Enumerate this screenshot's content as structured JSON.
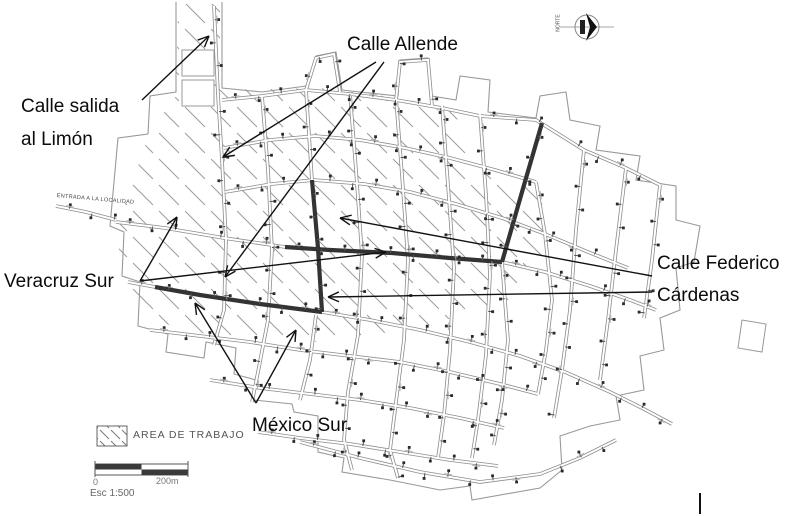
{
  "annotations": {
    "salida_limon": {
      "line1": "Calle salida",
      "line2": "al Limón"
    },
    "allende": {
      "label": "Calle Allende"
    },
    "veracruz": {
      "label": "Veracruz Sur"
    },
    "federico": {
      "line1": "Calle Federico",
      "line2": "Cárdenas"
    },
    "mexico": {
      "label": "México Sur"
    }
  },
  "map_texts": {
    "entrance_road": "ENTRADA A LA LOCALIDAD",
    "north": "NORTE"
  },
  "legend": {
    "work_area": "AREA DE TRABAJO"
  },
  "scale_bar": {
    "start": "0",
    "end": "200m",
    "scale": "Esc 1:500"
  },
  "colors": {
    "ink": "#111111",
    "street_casing": "#8c8c8c",
    "bold_street": "#333333",
    "hatch": "#9a9a9a",
    "boundary": "#999999",
    "tick": "#555555",
    "tick_head": "#2a2a2a"
  },
  "geometry": {
    "boundary": [
      [
        176,
        2
      ],
      [
        176,
        92
      ],
      [
        150,
        96
      ],
      [
        148,
        134
      ],
      [
        118,
        138
      ],
      [
        110,
        226
      ],
      [
        124,
        232
      ],
      [
        122,
        276
      ],
      [
        140,
        282
      ],
      [
        138,
        326
      ],
      [
        168,
        334
      ],
      [
        166,
        352
      ],
      [
        204,
        358
      ],
      [
        206,
        342
      ],
      [
        236,
        348
      ],
      [
        234,
        374
      ],
      [
        256,
        380
      ],
      [
        254,
        400
      ],
      [
        292,
        404
      ],
      [
        294,
        412
      ],
      [
        318,
        416
      ],
      [
        318,
        452
      ],
      [
        344,
        458
      ],
      [
        342,
        472
      ],
      [
        390,
        480
      ],
      [
        440,
        490
      ],
      [
        470,
        486
      ],
      [
        472,
        500
      ],
      [
        540,
        488
      ],
      [
        562,
        470
      ],
      [
        560,
        436
      ],
      [
        590,
        426
      ],
      [
        620,
        420
      ],
      [
        616,
        396
      ],
      [
        644,
        390
      ],
      [
        640,
        356
      ],
      [
        664,
        350
      ],
      [
        660,
        318
      ],
      [
        680,
        310
      ],
      [
        676,
        268
      ],
      [
        694,
        262
      ],
      [
        700,
        226
      ],
      [
        676,
        220
      ],
      [
        676,
        186
      ],
      [
        636,
        180
      ],
      [
        640,
        156
      ],
      [
        596,
        150
      ],
      [
        600,
        126
      ],
      [
        570,
        120
      ],
      [
        566,
        92
      ],
      [
        540,
        96
      ],
      [
        536,
        118
      ],
      [
        488,
        112
      ],
      [
        490,
        80
      ],
      [
        460,
        76
      ],
      [
        456,
        100
      ],
      [
        432,
        96
      ],
      [
        428,
        58
      ],
      [
        400,
        60
      ],
      [
        398,
        96
      ],
      [
        360,
        92
      ],
      [
        342,
        90
      ],
      [
        336,
        52
      ],
      [
        316,
        56
      ],
      [
        306,
        86
      ],
      [
        262,
        92
      ],
      [
        222,
        88
      ],
      [
        222,
        2
      ]
    ],
    "far_block": [
      [
        742,
        320
      ],
      [
        766,
        324
      ],
      [
        762,
        352
      ],
      [
        738,
        348
      ],
      [
        742,
        320
      ]
    ],
    "hatch_poly": [
      [
        178,
        4
      ],
      [
        220,
        4
      ],
      [
        220,
        90
      ],
      [
        320,
        88
      ],
      [
        400,
        98
      ],
      [
        455,
        110
      ],
      [
        470,
        170
      ],
      [
        540,
        188
      ],
      [
        548,
        248
      ],
      [
        508,
        300
      ],
      [
        430,
        325
      ],
      [
        330,
        342
      ],
      [
        230,
        340
      ],
      [
        150,
        320
      ],
      [
        122,
        270
      ],
      [
        116,
        228
      ],
      [
        150,
        132
      ],
      [
        176,
        96
      ]
    ],
    "white_blocks": [
      [
        182,
        50,
        32,
        26
      ],
      [
        182,
        80,
        32,
        26
      ]
    ],
    "streets": [
      [
        [
          214,
          6
        ],
        [
          218,
          95
        ],
        [
          222,
          160
        ],
        [
          226,
          240
        ],
        [
          224,
          310
        ],
        [
          214,
          345
        ]
      ],
      [
        [
          262,
          96
        ],
        [
          268,
          170
        ],
        [
          272,
          250
        ],
        [
          268,
          320
        ],
        [
          258,
          372
        ],
        [
          252,
          402
        ]
      ],
      [
        [
          306,
          90
        ],
        [
          312,
          180
        ]
      ],
      [
        [
          316,
          315
        ],
        [
          310,
          360
        ],
        [
          300,
          400
        ]
      ],
      [
        [
          350,
          94
        ],
        [
          356,
          170
        ],
        [
          362,
          255
        ],
        [
          358,
          335
        ],
        [
          348,
          392
        ],
        [
          344,
          440
        ],
        [
          352,
          470
        ]
      ],
      [
        [
          396,
          98
        ],
        [
          402,
          175
        ],
        [
          408,
          260
        ],
        [
          404,
          340
        ],
        [
          396,
          402
        ],
        [
          390,
          450
        ],
        [
          398,
          478
        ]
      ],
      [
        [
          442,
          106
        ],
        [
          448,
          185
        ],
        [
          454,
          268
        ],
        [
          450,
          350
        ],
        [
          444,
          415
        ],
        [
          438,
          458
        ]
      ],
      [
        [
          480,
          114
        ],
        [
          486,
          195
        ],
        [
          490,
          275
        ],
        [
          486,
          355
        ],
        [
          478,
          420
        ],
        [
          472,
          458
        ]
      ],
      [
        [
          502,
          262
        ],
        [
          508,
          340
        ],
        [
          502,
          400
        ],
        [
          494,
          445
        ]
      ],
      [
        [
          584,
          150
        ],
        [
          576,
          230
        ],
        [
          570,
          310
        ],
        [
          562,
          370
        ],
        [
          554,
          418
        ]
      ],
      [
        [
          626,
          168
        ],
        [
          616,
          250
        ],
        [
          608,
          320
        ],
        [
          600,
          380
        ]
      ],
      [
        [
          660,
          185
        ],
        [
          652,
          260
        ],
        [
          644,
          318
        ]
      ],
      [
        [
          536,
          182
        ],
        [
          545,
          234
        ],
        [
          552,
          300
        ],
        [
          546,
          350
        ],
        [
          538,
          394
        ]
      ],
      [
        [
          222,
          100
        ],
        [
          262,
          96
        ],
        [
          306,
          90
        ],
        [
          350,
          94
        ],
        [
          396,
          100
        ],
        [
          442,
          108
        ],
        [
          480,
          116
        ]
      ],
      [
        [
          224,
          148
        ],
        [
          270,
          140
        ],
        [
          315,
          136
        ],
        [
          360,
          140
        ],
        [
          405,
          148
        ],
        [
          450,
          158
        ],
        [
          495,
          170
        ],
        [
          536,
          182
        ]
      ],
      [
        [
          225,
          192
        ],
        [
          272,
          184
        ],
        [
          314,
          180
        ],
        [
          364,
          184
        ],
        [
          410,
          192
        ],
        [
          456,
          204
        ],
        [
          502,
          218
        ],
        [
          545,
          234
        ],
        [
          588,
          252
        ],
        [
          628,
          268
        ]
      ],
      [
        [
          116,
          222
        ],
        [
          165,
          228
        ],
        [
          224,
          238
        ],
        [
          285,
          247
        ]
      ],
      [
        [
          502,
          262
        ],
        [
          545,
          272
        ],
        [
          590,
          286
        ],
        [
          630,
          300
        ],
        [
          656,
          310
        ]
      ],
      [
        [
          128,
          282
        ],
        [
          155,
          287
        ]
      ],
      [
        [
          322,
          312
        ],
        [
          370,
          320
        ],
        [
          420,
          330
        ],
        [
          470,
          342
        ],
        [
          520,
          356
        ],
        [
          565,
          372
        ],
        [
          610,
          392
        ],
        [
          642,
          408
        ],
        [
          672,
          424
        ]
      ],
      [
        [
          150,
          330
        ],
        [
          200,
          336
        ],
        [
          250,
          342
        ],
        [
          300,
          350
        ],
        [
          350,
          356
        ],
        [
          400,
          362
        ],
        [
          450,
          372
        ],
        [
          500,
          384
        ],
        [
          538,
          394
        ]
      ],
      [
        [
          210,
          380
        ],
        [
          260,
          388
        ],
        [
          310,
          394
        ],
        [
          360,
          400
        ],
        [
          410,
          408
        ],
        [
          460,
          418
        ],
        [
          504,
          428
        ]
      ],
      [
        [
          258,
          432
        ],
        [
          300,
          438
        ],
        [
          350,
          444
        ],
        [
          400,
          452
        ],
        [
          450,
          460
        ],
        [
          498,
          466
        ]
      ],
      [
        [
          300,
          442
        ],
        [
          360,
          458
        ],
        [
          420,
          472
        ],
        [
          480,
          482
        ],
        [
          540,
          474
        ],
        [
          580,
          458
        ],
        [
          616,
          440
        ]
      ],
      [
        [
          396,
          100
        ],
        [
          400,
          62
        ],
        [
          428,
          60
        ],
        [
          432,
          106
        ]
      ],
      [
        [
          306,
          90
        ],
        [
          316,
          58
        ],
        [
          334,
          54
        ],
        [
          340,
          92
        ]
      ],
      [
        [
          480,
          116
        ],
        [
          536,
          120
        ],
        [
          584,
          150
        ],
        [
          626,
          168
        ],
        [
          660,
          185
        ]
      ],
      [
        [
          56,
          206
        ],
        [
          86,
          212
        ],
        [
          116,
          220
        ]
      ]
    ],
    "bold_streets": [
      [
        [
          542,
          123
        ],
        [
          522,
          192
        ],
        [
          502,
          262
        ]
      ],
      [
        [
          285,
          247
        ],
        [
          330,
          250
        ],
        [
          392,
          253
        ],
        [
          450,
          258
        ],
        [
          502,
          262
        ]
      ],
      [
        [
          312,
          180
        ],
        [
          318,
          248
        ],
        [
          322,
          312
        ]
      ],
      [
        [
          155,
          287
        ],
        [
          200,
          295
        ],
        [
          260,
          304
        ],
        [
          322,
          312
        ]
      ]
    ],
    "arrows": [
      {
        "from": [
          142,
          100
        ],
        "to": [
          209,
          36
        ]
      },
      {
        "from": [
          376,
          62
        ],
        "to": [
          223,
          157
        ]
      },
      {
        "from": [
          384,
          62
        ],
        "to": [
          225,
          277
        ]
      },
      {
        "from": [
          140,
          281
        ],
        "to": [
          177,
          217
        ]
      },
      {
        "from": [
          140,
          281
        ],
        "to": [
          386,
          252
        ]
      },
      {
        "from": [
          652,
          276
        ],
        "to": [
          340,
          218
        ]
      },
      {
        "from": [
          652,
          292
        ],
        "to": [
          328,
          297
        ]
      },
      {
        "from": [
          256,
          403
        ],
        "to": [
          195,
          303
        ]
      },
      {
        "from": [
          256,
          403
        ],
        "to": [
          296,
          330
        ]
      }
    ],
    "compass": {
      "cx": 587,
      "cy": 27
    },
    "legend_box": [
      97,
      426,
      30,
      20
    ],
    "scale_rect": [
      95,
      464,
      93,
      11
    ],
    "stray_mark": [
      700,
      493,
      700,
      514
    ]
  }
}
